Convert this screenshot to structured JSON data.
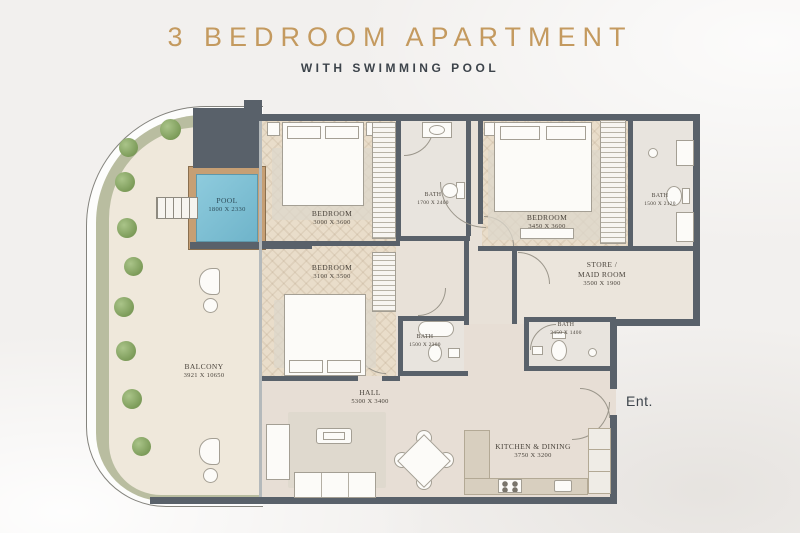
{
  "header": {
    "title": "3 BEDROOM APARTMENT",
    "subtitle": "WITH SWIMMING POOL"
  },
  "entrance": {
    "label": "Ent."
  },
  "rooms": {
    "pool": {
      "name": "POOL",
      "dims": "1800 X 2330"
    },
    "bedroom_top_left": {
      "name": "BEDROOM",
      "dims": "3000 X 3600"
    },
    "bath_top_middle": {
      "name": "BATH",
      "dims": "1700 X 2400"
    },
    "bedroom_top_right": {
      "name": "BEDROOM",
      "dims": "3450 X 3600"
    },
    "bath_top_right": {
      "name": "BATH",
      "dims": "1500 X 2120"
    },
    "bedroom_middle": {
      "name": "BEDROOM",
      "dims": "3100 X 3500"
    },
    "store": {
      "name_line1": "STORE /",
      "name_line2": "MAID ROOM",
      "dims": "3500 X 1900"
    },
    "bath_middle": {
      "name": "BATH",
      "dims": "1500 X 2300"
    },
    "bath_store": {
      "name": "BATH",
      "dims": "2450 X 1400"
    },
    "balcony": {
      "name": "BALCONY",
      "dims": "3921 X 10650"
    },
    "hall": {
      "name": "HALL",
      "dims": "5300 X 3400"
    },
    "kitchen": {
      "name": "KITCHEN & DINING",
      "dims": "3750 X 3200"
    }
  },
  "colors": {
    "accent_gold": "#c49a5f",
    "subtitle_gray": "#3d444b",
    "wall": "#59616a",
    "pool_water": "#84c3d8",
    "pool_deck": "#c69f74",
    "planter_green": "#b9bda0",
    "tree_green": "#7e9d5b",
    "interior_floor": "#e8e1d8",
    "wood_floor": "#e9ddca",
    "label_text": "#4a443c"
  }
}
